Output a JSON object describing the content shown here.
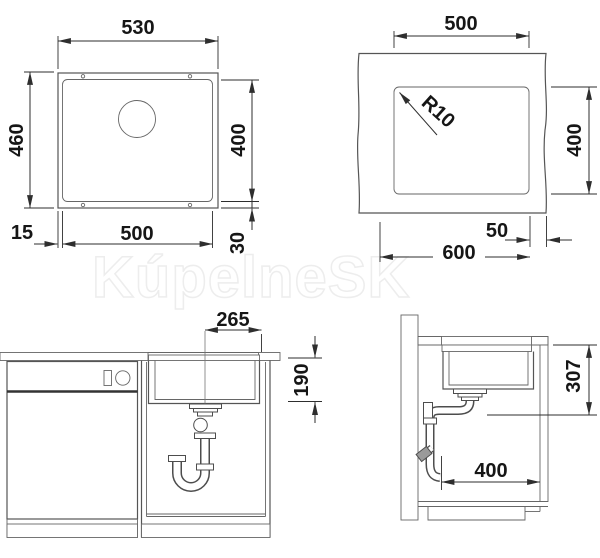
{
  "watermark": {
    "text": "KúpelneSK"
  },
  "views": {
    "sink_top": {
      "width_outer": "530",
      "height_outer": "460",
      "bowl_height": "400",
      "bowl_width": "500",
      "edge_offset_left": "15",
      "edge_offset_bottom": "30"
    },
    "cutout_top": {
      "cutout_width": "500",
      "corner_radius": "R10",
      "cutout_height": "400",
      "edge_offset": "50",
      "cabinet_width": "600"
    },
    "front": {
      "drain_offset": "265",
      "bowl_depth": "190"
    },
    "side": {
      "drain_height": "307",
      "min_depth": "400"
    }
  }
}
